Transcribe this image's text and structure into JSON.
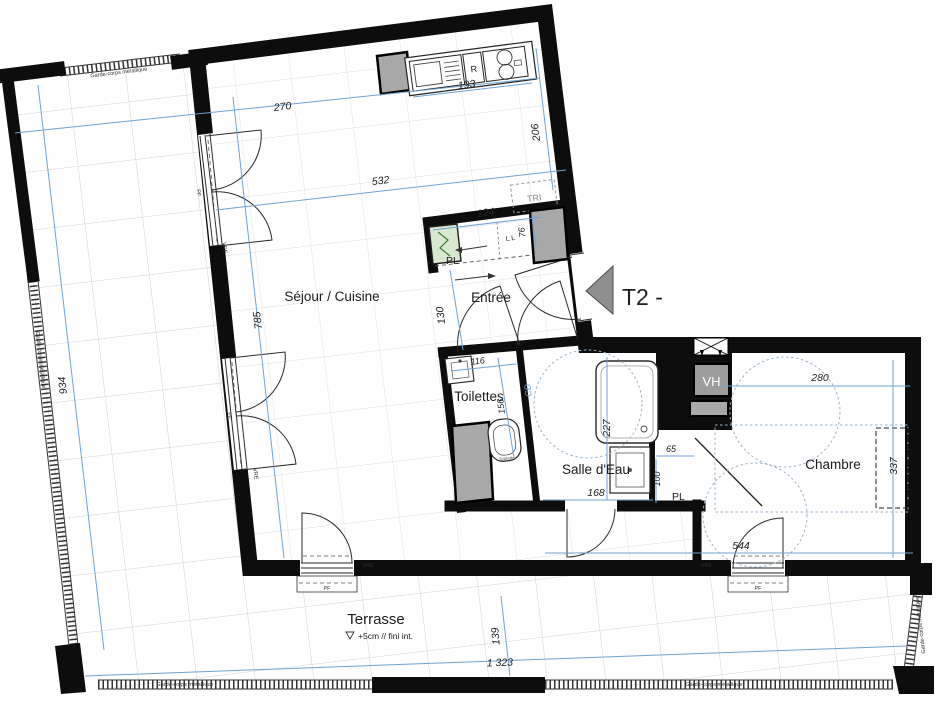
{
  "plan": {
    "type_label": "T2 -",
    "rooms": {
      "sejour": "Séjour / Cuisine",
      "entree": "Entrée",
      "toilettes": "Toilettes",
      "salle_eau": "Salle d'Eau",
      "chambre": "Chambre",
      "terrasse": "Terrasse"
    },
    "terrasse_note": "+5cm // fini int.",
    "fixtures": {
      "fridge": "R",
      "tri": "TRI",
      "vh": "VH",
      "cd": "CD",
      "tablette": "Tablette",
      "closet": "PL",
      "closet_marks": "L L"
    },
    "window_labels": {
      "vre": "VRE",
      "pf": "PF"
    },
    "railing_label": "Garde-corps métallique",
    "dims": {
      "terrace_width": "270",
      "sejour_width": "532",
      "kitchen_counter": "193",
      "kitchen_depth": "206",
      "closet_width": "124",
      "closet_gap": "76",
      "entree_depth": "130",
      "sejour_length": "785",
      "terrace_west_length": "934",
      "toilettes_width": "116",
      "toilettes_depth": "156",
      "salle_eau_depth": "227",
      "salle_eau_width": "168",
      "vanity_width": "65",
      "vanity_depth": "100",
      "chambre_width": "280",
      "chambre_depth": "337",
      "chambre_total": "544",
      "terrace_south_depth": "139",
      "terrace_south_length": "1 323"
    },
    "colors": {
      "wall": "#0d0d0d",
      "dim_line": "#6fa3d4",
      "duct_gray": "#a8a8a8",
      "panel_green": "#d9e8d0",
      "marker_gray": "#8f8f8f"
    }
  }
}
